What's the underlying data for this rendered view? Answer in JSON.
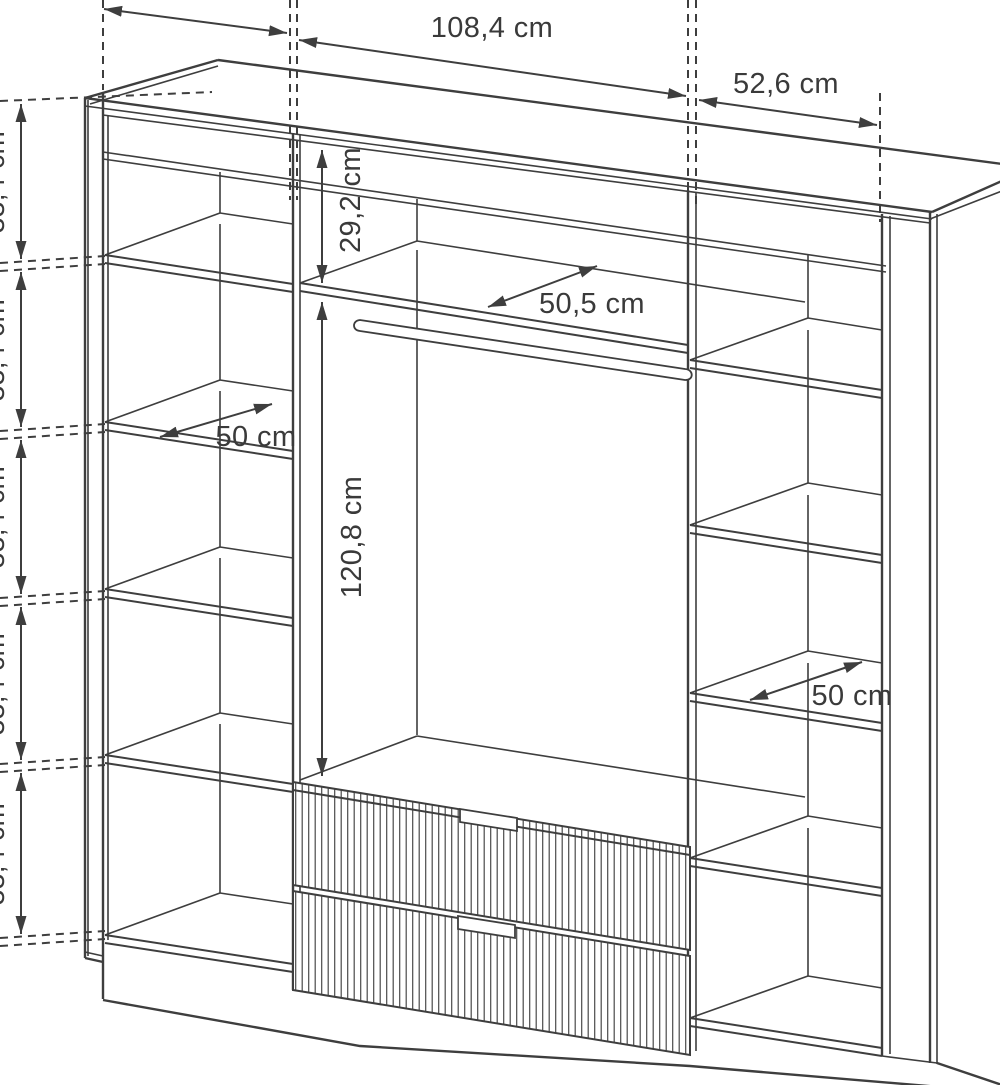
{
  "diagram": {
    "type": "furniture-dimension-drawing",
    "subject": "wardrobe interior with shelves, hanging rod and two fluted drawers",
    "unit": "cm",
    "ink_color": "#3e3e3e",
    "background_color": "#ffffff",
    "labels": {
      "top_center_width": "108,4 cm",
      "top_right_width": "52,6 cm",
      "top_shelf_clearance": "29,2 cm",
      "center_shelf_depth": "50,5 cm",
      "left_shelf_depth": "50 cm",
      "hanging_space_height": "120,8 cm",
      "right_shelf_depth": "50 cm",
      "left_segments": [
        "33,4 cm",
        "33,4 cm",
        "33,4 cm",
        "33,4 cm",
        "33,4 cm"
      ]
    },
    "features": {
      "left_column_shelves": 4,
      "right_column_shelves": 4,
      "drawers": 2,
      "hanging_rod": 1
    }
  }
}
